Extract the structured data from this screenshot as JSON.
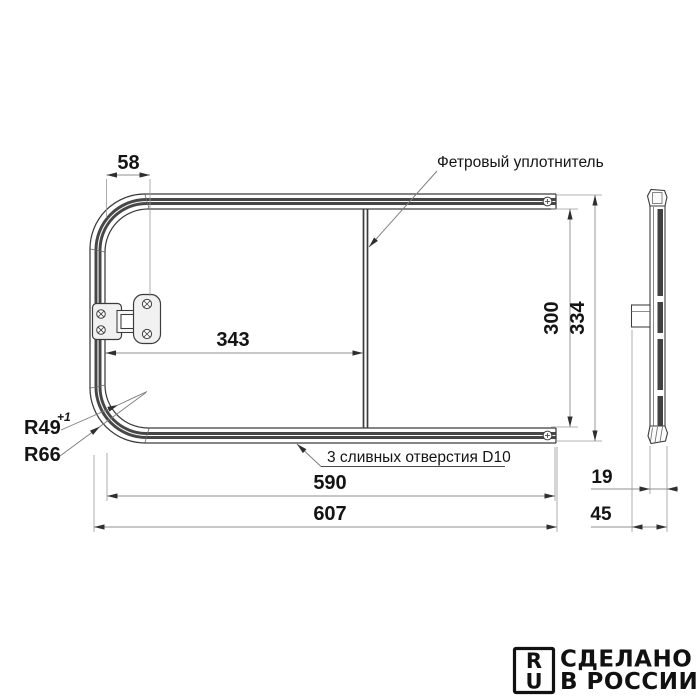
{
  "drawing": {
    "dims": {
      "d58": "58",
      "d343": "343",
      "d300": "300",
      "d334": "334",
      "d590": "590",
      "d607": "607",
      "d19": "19",
      "d45": "45"
    },
    "labels": {
      "felt_seal": "Фетровый уплотнитель",
      "drain_holes": "3 сливных отверстия D10",
      "r_inner": "R49",
      "r_inner_tol": "+1",
      "r_outer": "R66"
    },
    "logo": {
      "letter_r": "R",
      "letter_u": "U",
      "line1": "СДЕЛАНО",
      "line2": "В РОССИИ"
    },
    "colors": {
      "contour": "#3c3c3c",
      "seal_band": "#474747",
      "dimension_line": "#8f8f8f",
      "text": "#141414",
      "background": "#ffffff"
    }
  }
}
